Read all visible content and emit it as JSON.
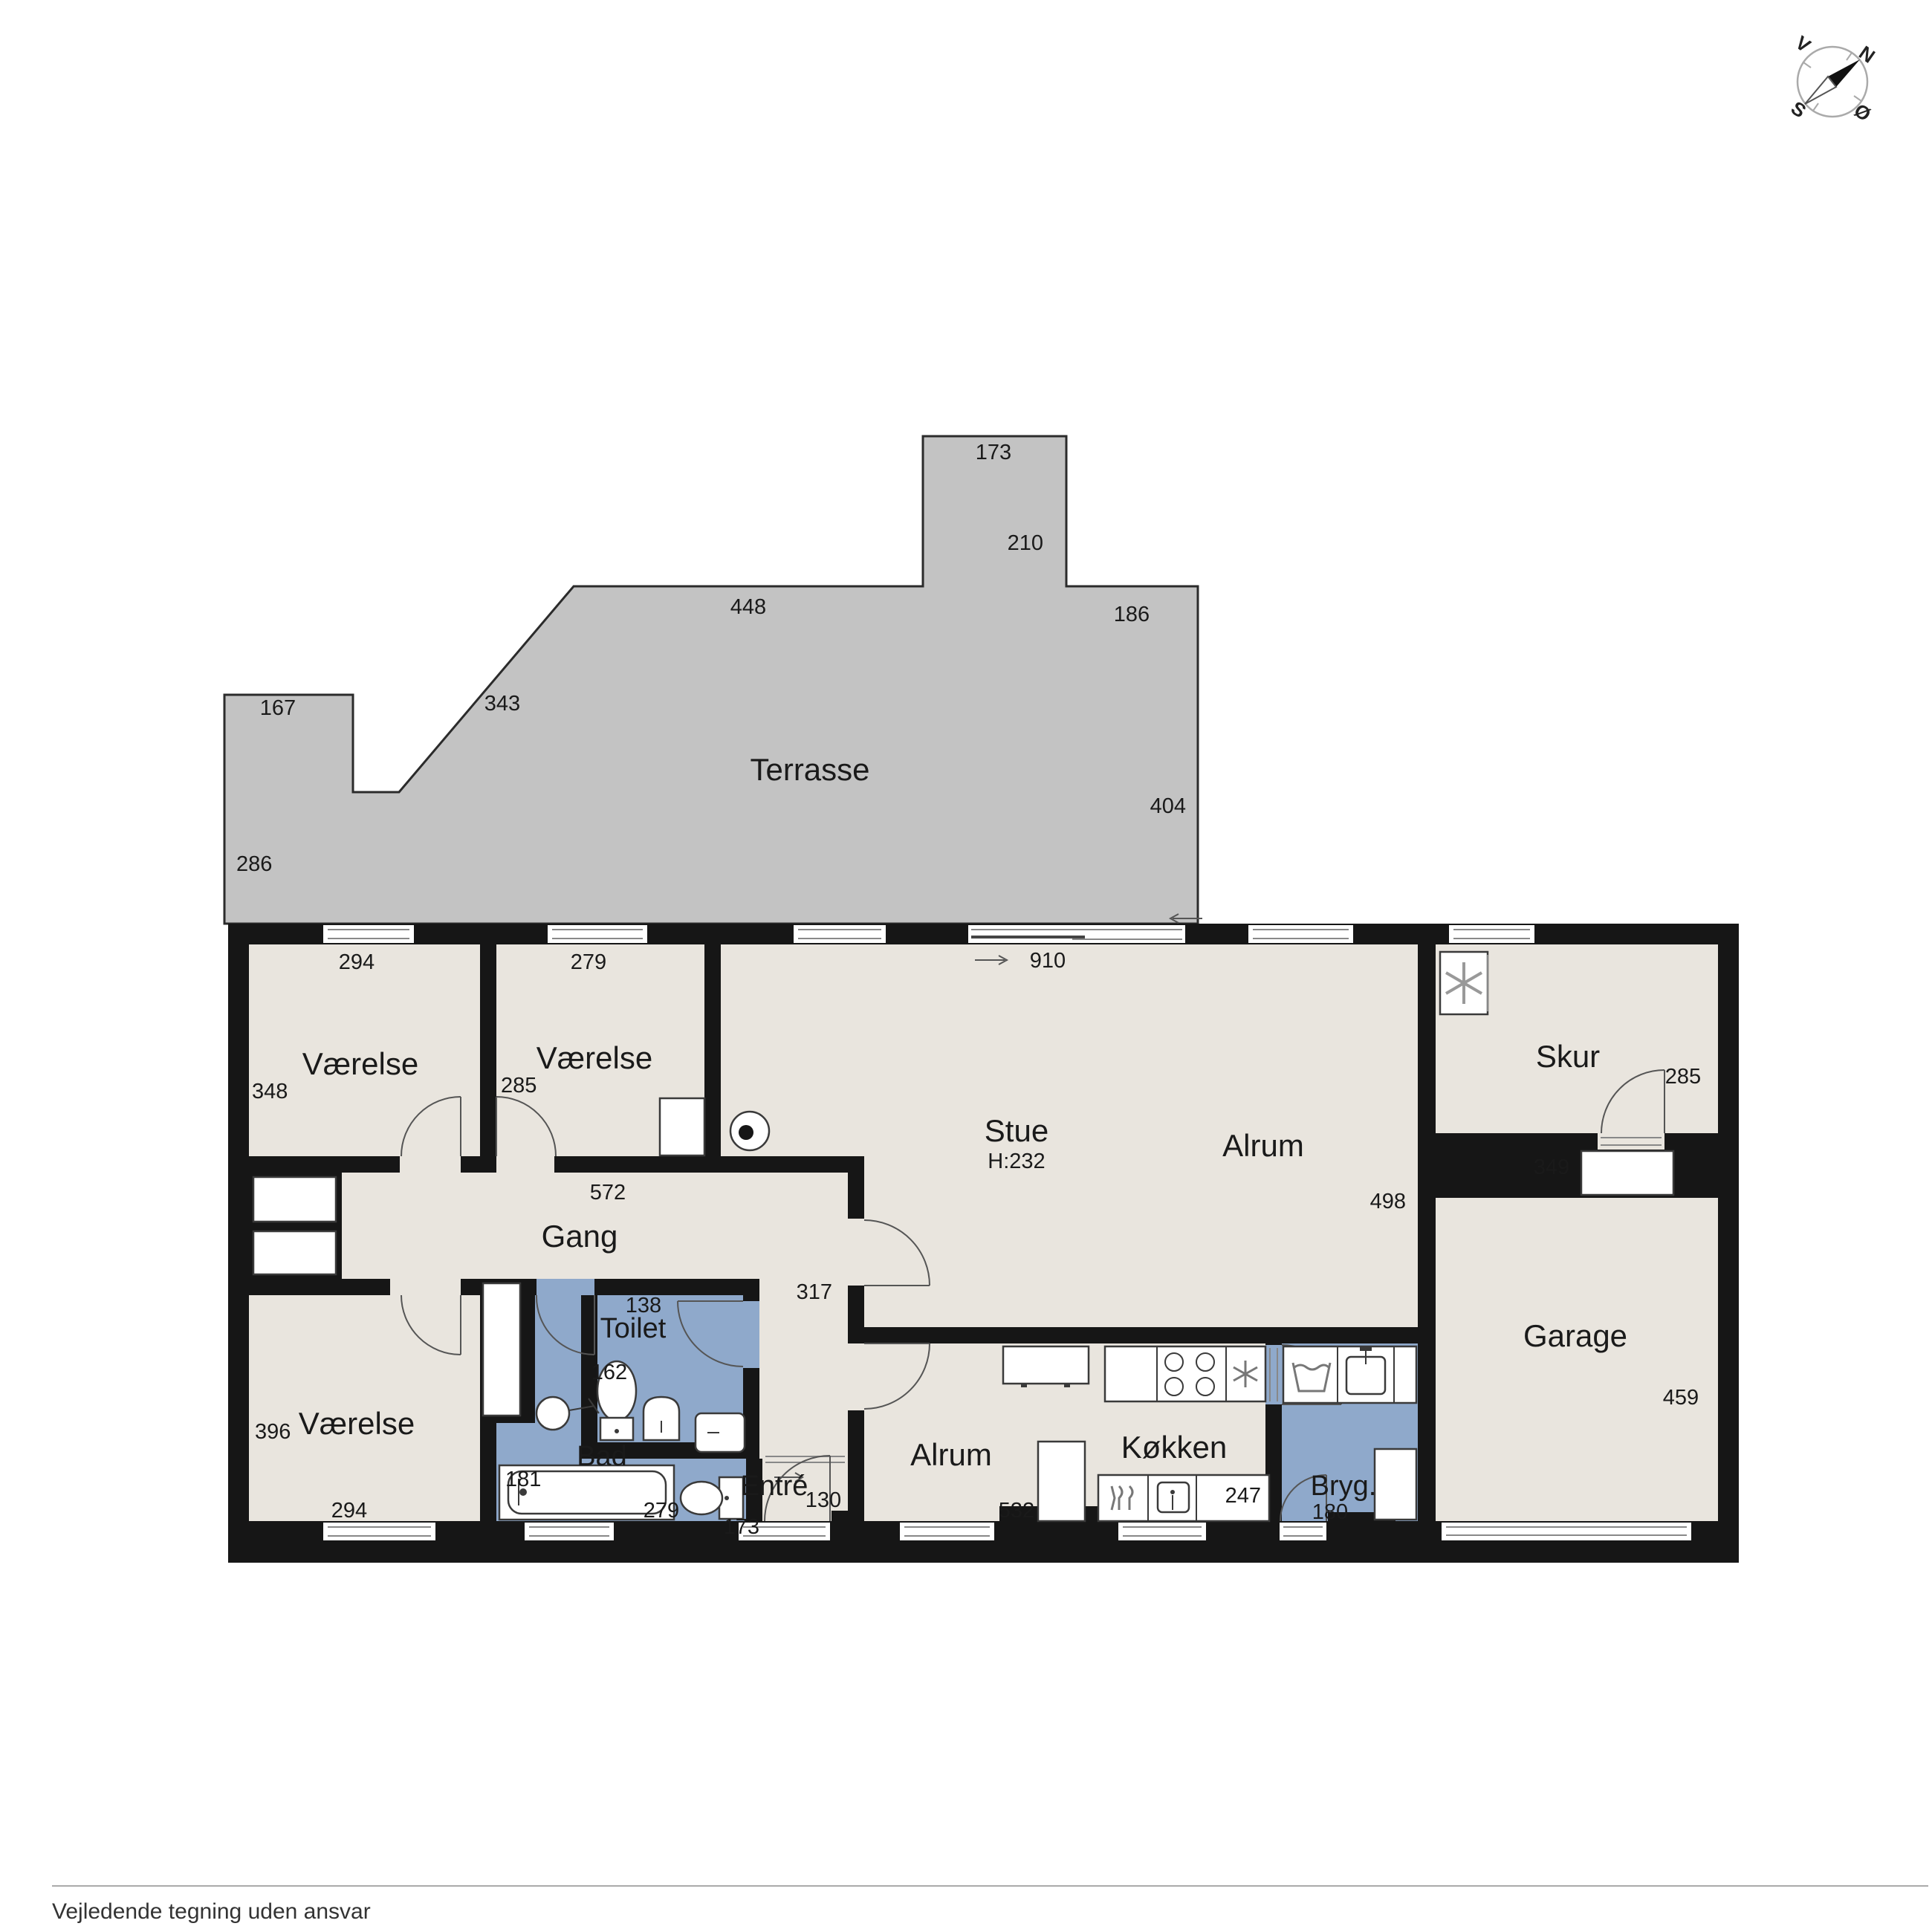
{
  "rooms": {
    "terrasse": "Terrasse",
    "vaerelse1": "Værelse",
    "vaerelse2": "Værelse",
    "vaerelse3": "Værelse",
    "stue": "Stue",
    "stue_height": "H:232",
    "alrum_upper": "Alrum",
    "alrum_lower": "Alrum",
    "gang": "Gang",
    "toilet": "Toilet",
    "bad": "Bad",
    "entre": "Entré",
    "kokken": "Køkken",
    "bryg": "Bryg.",
    "skur": "Skur",
    "garage": "Garage"
  },
  "dims": {
    "terrace_173": "173",
    "terrace_210": "210",
    "terrace_448": "448",
    "terrace_186": "186",
    "terrace_167": "167",
    "terrace_343": "343",
    "terrace_286": "286",
    "terrace_404": "404",
    "v1_294": "294",
    "v1_348": "348",
    "v2_279": "279",
    "v2_285": "285",
    "stue_910": "910",
    "alrum_498": "498",
    "gang_572": "572",
    "hall_317": "317",
    "toilet_138": "138",
    "toilet_162": "162",
    "bad_181": "181",
    "bad_279": "279",
    "v3_396": "396",
    "v3_294": "294",
    "entre_173": "173",
    "entre_130": "130",
    "alrum2_532": "532",
    "kokken_247": "247",
    "bryg_180": "180",
    "skur_285": "285",
    "skur_349": "349",
    "garage_459": "459"
  },
  "compass": {
    "n": "N",
    "s": "S",
    "v": "V",
    "o": "Ø"
  },
  "footer": {
    "disclaimer": "Vejledende tegning uden ansvar"
  },
  "colors": {
    "room_fill": "#e9e5de",
    "wet_room_fill": "#8fa9cb",
    "terrace_fill": "#c3c3c3",
    "wall": "#161616"
  }
}
